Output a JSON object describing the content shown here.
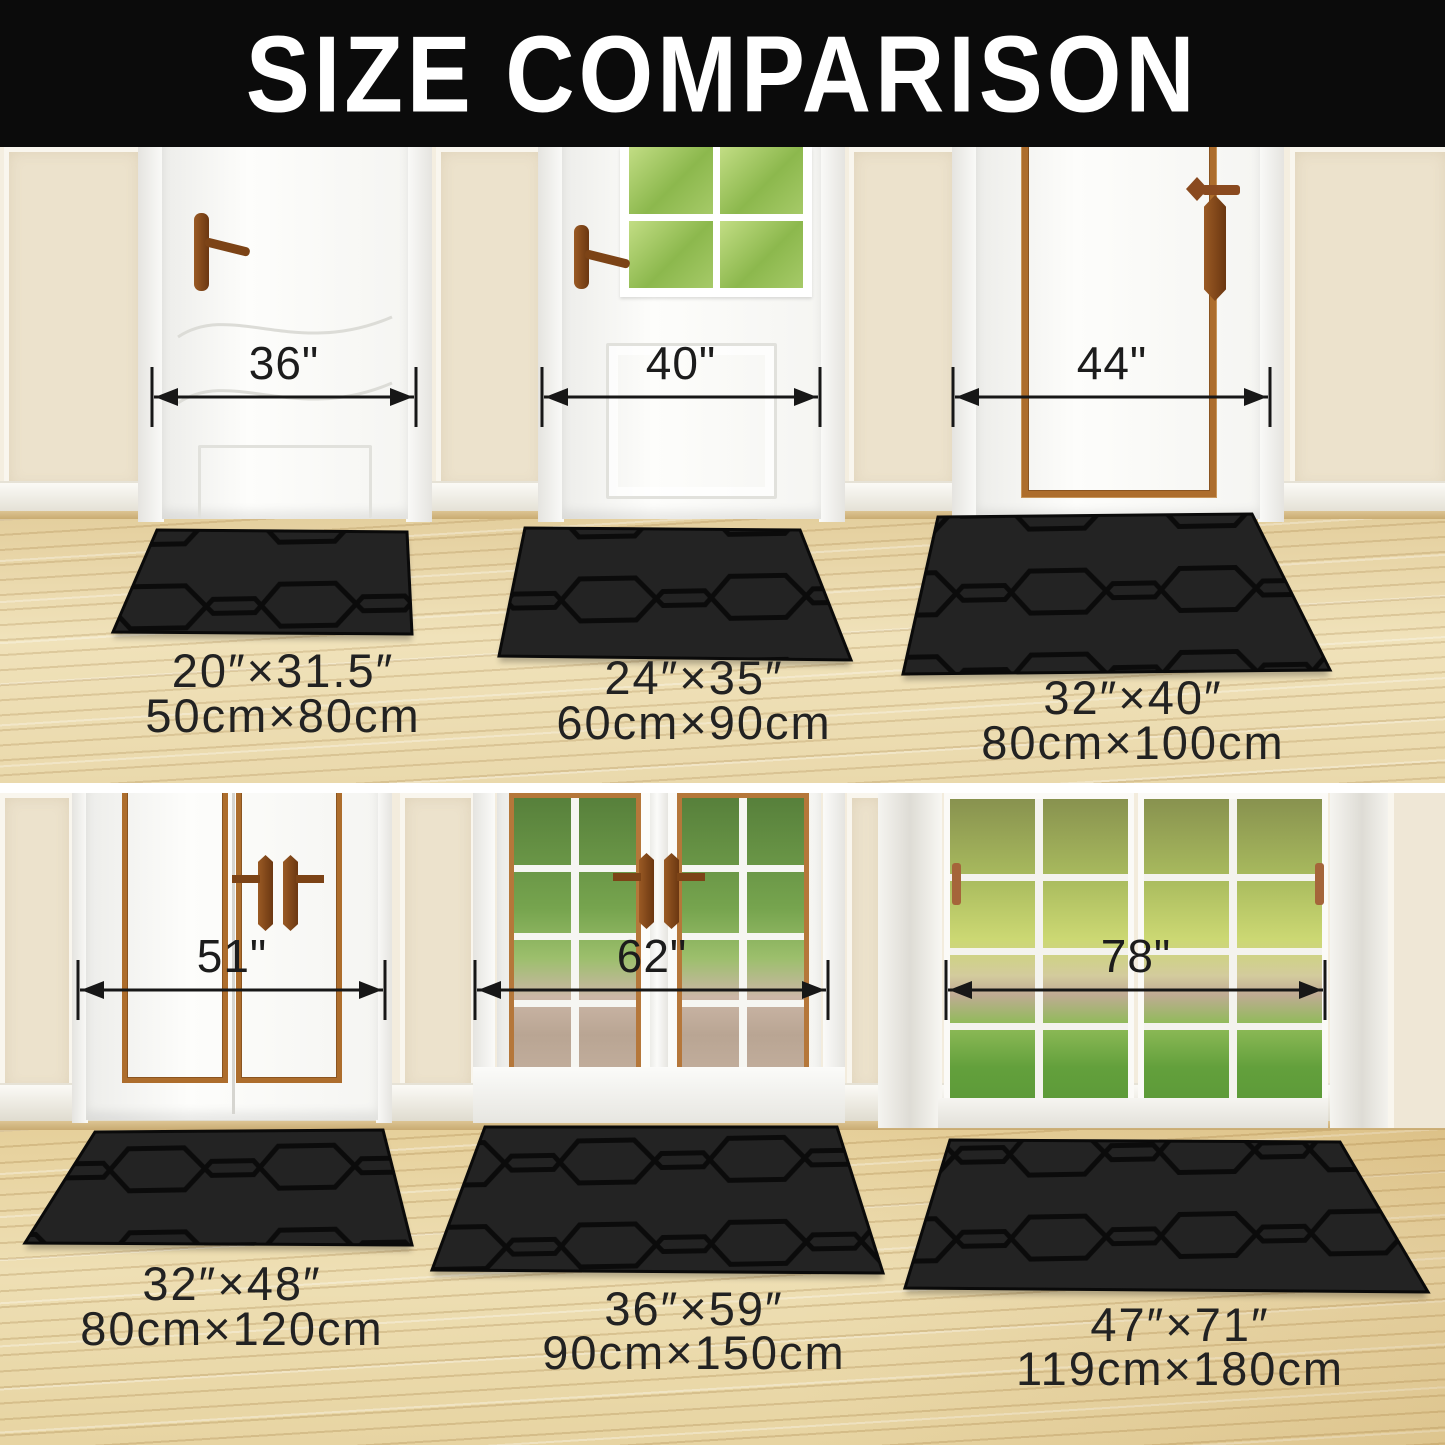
{
  "title": "SIZE COMPARISON",
  "colors": {
    "banner_bg": "#0b0b0b",
    "banner_text": "#ffffff",
    "arrow_and_text": "#1c1c1c",
    "mat_base": "#232323",
    "mat_groove": "#0b0b0b",
    "wall_cream": "#f2ebdb",
    "wood_floor": "#ead9ac",
    "door_trim_brown": "#ad6d2c",
    "handle_brown": "#7c4316",
    "window_green": "#8cb84d"
  },
  "top_row": {
    "doors": [
      {
        "name": "single-panel-door",
        "width_label": "36\""
      },
      {
        "name": "half-window-door",
        "width_label": "40\""
      },
      {
        "name": "brown-trim-door",
        "width_label": "44\""
      }
    ],
    "mats": [
      {
        "inches": "20″×31.5″",
        "metric": "50cm×80cm"
      },
      {
        "inches": "24″×35″",
        "metric": "60cm×90cm"
      },
      {
        "inches": "32″×40″",
        "metric": "80cm×100cm"
      }
    ]
  },
  "bottom_row": {
    "doors": [
      {
        "name": "double-panel-door",
        "width_label": "51\""
      },
      {
        "name": "french-glass-door",
        "width_label": "62\""
      },
      {
        "name": "patio-glass-door",
        "width_label": "78\""
      }
    ],
    "mats": [
      {
        "inches": "32″×48″",
        "metric": "80cm×120cm"
      },
      {
        "inches": "36″×59″",
        "metric": "90cm×150cm"
      },
      {
        "inches": "47″×71″",
        "metric": "119cm×180cm"
      }
    ]
  }
}
